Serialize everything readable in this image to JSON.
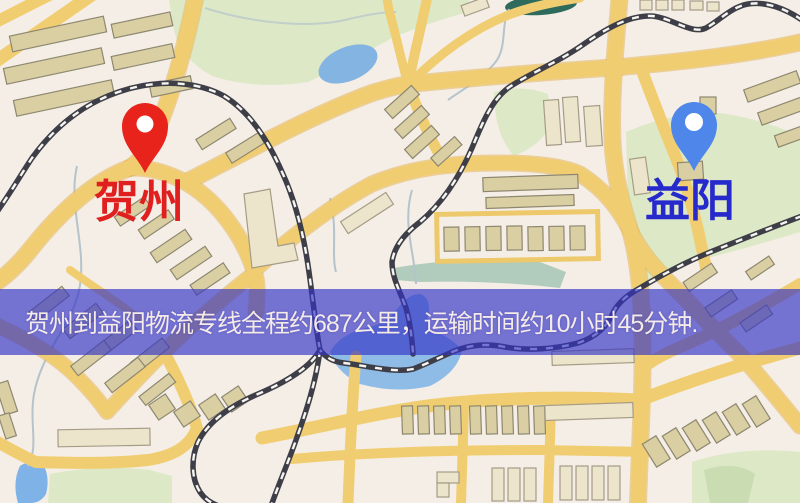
{
  "map": {
    "origin": {
      "label": "贺州",
      "pin_color": "#e8231c",
      "label_color": "#e01f1f"
    },
    "destination": {
      "label": "益阳",
      "pin_color": "#4e86e9",
      "label_color": "#2629cc"
    },
    "palette": {
      "background": "#f4eee6",
      "road": "#f1cd72",
      "building": "#d9cfa2",
      "building_light": "#ece4cb",
      "water": "#8fbbe7",
      "park": "#dde9c6",
      "railway": "#3e3e48"
    }
  },
  "banner": {
    "text": "贺州到益阳物流专线全程约687公里，运输时间约10小时45分钟.",
    "background": "#3333c5",
    "text_color": "#f4eae6"
  }
}
